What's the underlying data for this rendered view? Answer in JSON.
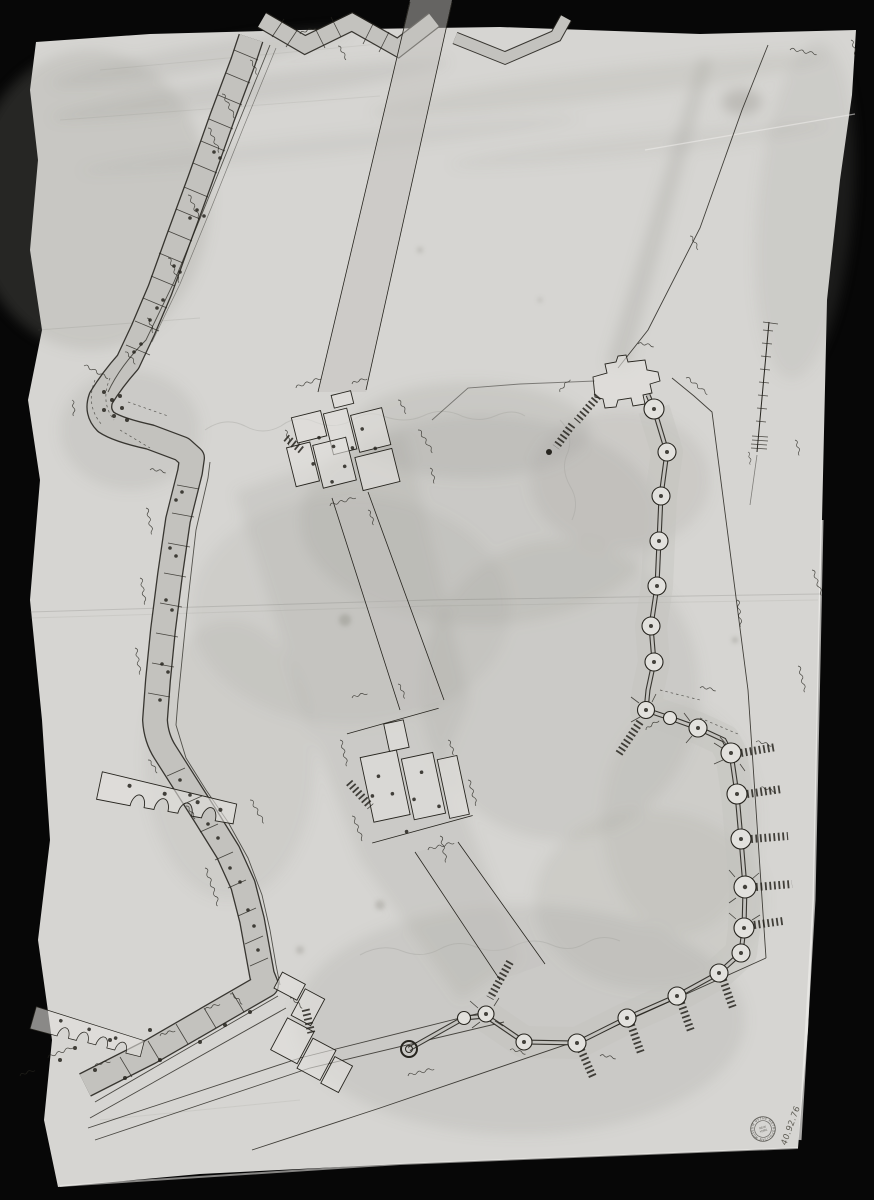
{
  "image": {
    "description": "Photograph of an aged pen-and-ink plan of city fortifications on creased paper",
    "accession_number": "40.92.76",
    "stamp": {
      "ring_text": "THE METROPOLITAN MUSEUM OF ART ·",
      "center_line1": "NEW",
      "center_line2": "YORK"
    },
    "handwritten_annotations": "illegible ink measurement scribbles",
    "features": [
      "bastioned-wall",
      "gate-complexes",
      "round-tower-wall",
      "scale-bar",
      "survey-lines",
      "merlon-battlements"
    ]
  },
  "colors": {
    "background": "#070707",
    "paper": "#d6d5d2",
    "paper_light": "#e2e1dd",
    "wash": "#c3c2be",
    "stain": "#98978f",
    "ink": "#27251f",
    "highlight": "#eeede9"
  }
}
